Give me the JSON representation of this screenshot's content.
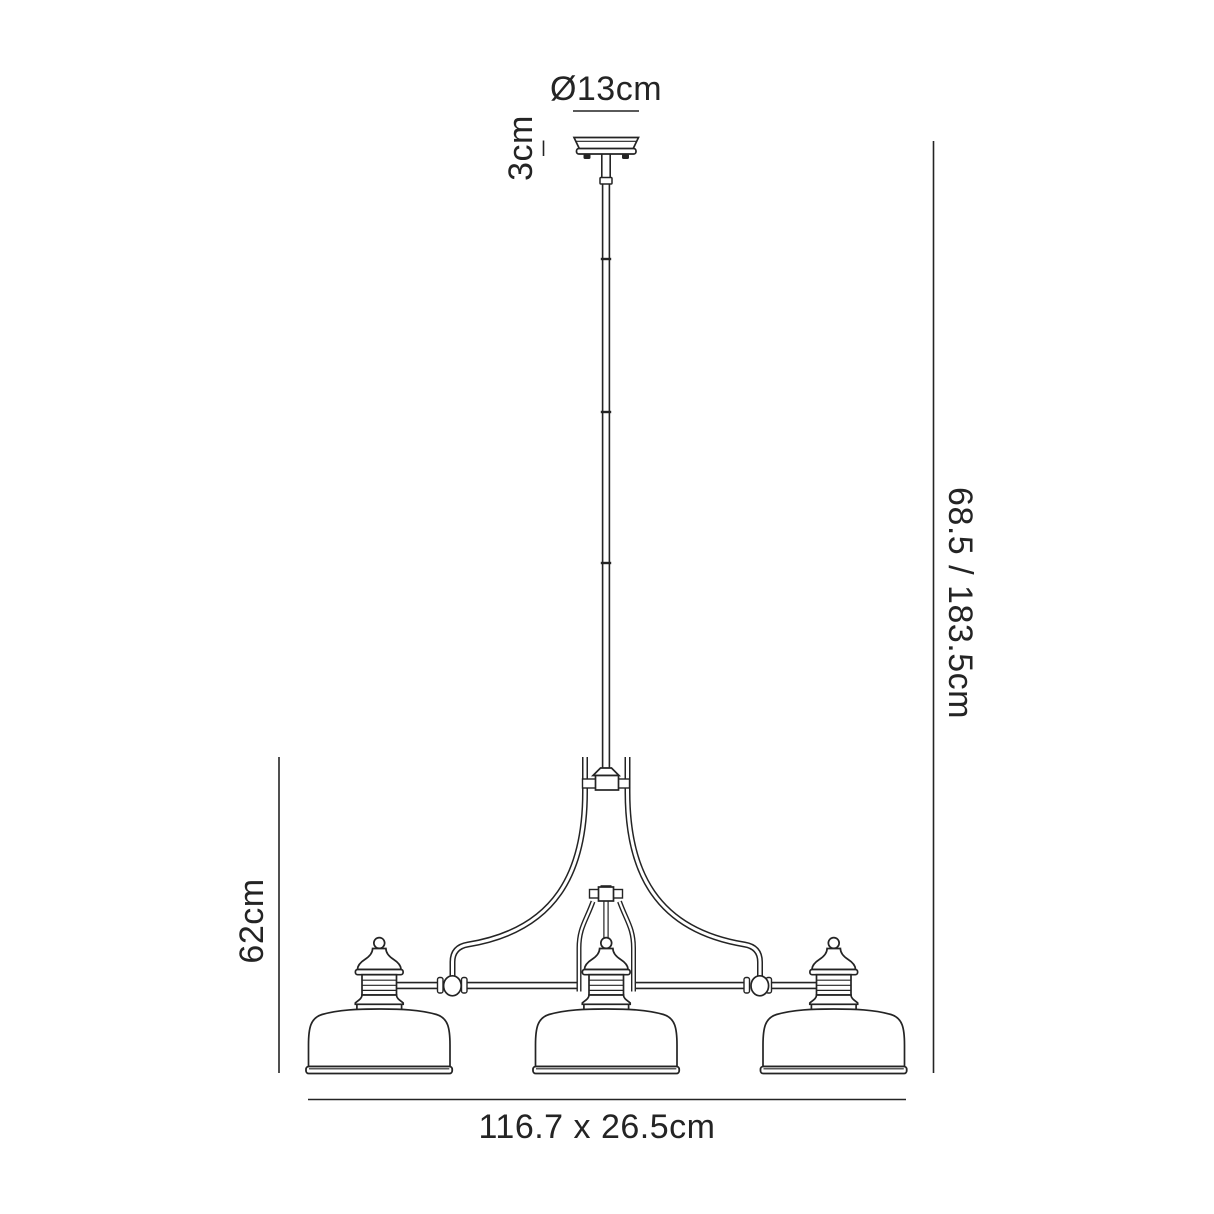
{
  "page": {
    "background": "#ffffff",
    "line_color": "#242424"
  },
  "diagram": {
    "labels": {
      "canopy_diameter": "Ø13cm",
      "canopy_height": "3cm",
      "overall_height_range": "68.5 / 183.5cm",
      "body_height": "62cm",
      "width_depth": "116.7 x 26.5cm"
    }
  }
}
